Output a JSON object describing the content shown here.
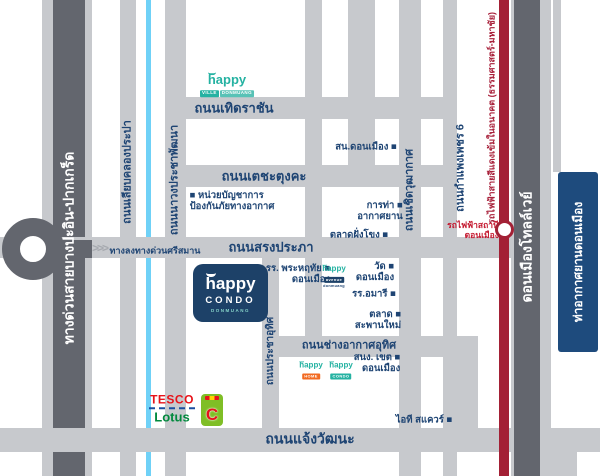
{
  "colors": {
    "road": "#c7c9cd",
    "road_dark": "#63666e",
    "canal": "#6fd1f7",
    "rail_red": "#a32035",
    "airport": "#1e4b7d",
    "navy": "#1e4473",
    "teal": "#25b2a2"
  },
  "map": {
    "ramp": {
      "chevrons": ">>>"
    },
    "roads": [
      {
        "name": "expressway-outer",
        "x": 42,
        "y": 0,
        "w": 50,
        "h": 476,
        "fill": "road"
      },
      {
        "name": "expressway-core",
        "x": 53,
        "y": 0,
        "w": 32,
        "h": 476,
        "fill": "road_dark"
      },
      {
        "name": "road-liap-khlong-prapa",
        "x": 120,
        "y": 0,
        "w": 16,
        "h": 476,
        "fill": "road"
      },
      {
        "name": "khlong-prapa-canal",
        "x": 146,
        "y": 0,
        "w": 5,
        "h": 476,
        "fill": "canal"
      },
      {
        "name": "road-nawong-pracha-phatthana",
        "x": 165,
        "y": 0,
        "w": 21,
        "h": 476,
        "fill": "road"
      },
      {
        "name": "road-thoet-rachan",
        "x": 165,
        "y": 97,
        "w": 281,
        "h": 22,
        "fill": "road"
      },
      {
        "name": "road-techa-tungkha",
        "x": 165,
        "y": 165,
        "w": 292,
        "h": 22,
        "fill": "road"
      },
      {
        "name": "road-song-prapha",
        "x": 0,
        "y": 237,
        "w": 515,
        "h": 21,
        "fill": "road"
      },
      {
        "name": "road-pracha-uthit",
        "x": 262,
        "y": 247,
        "w": 17,
        "h": 205,
        "fill": "road"
      },
      {
        "name": "road-top-a",
        "x": 305,
        "y": 0,
        "w": 17,
        "h": 357,
        "fill": "road"
      },
      {
        "name": "road-top-b",
        "x": 348,
        "y": 0,
        "w": 27,
        "h": 187,
        "fill": "road"
      },
      {
        "name": "road-cherd-wutthakat",
        "x": 399,
        "y": 0,
        "w": 22,
        "h": 476,
        "fill": "road"
      },
      {
        "name": "road-kamphaeng-phet-6",
        "x": 443,
        "y": 0,
        "w": 14,
        "h": 476,
        "fill": "road"
      },
      {
        "name": "road-chang-akat-uthit",
        "x": 262,
        "y": 336,
        "w": 216,
        "h": 21,
        "fill": "road"
      },
      {
        "name": "road-chang-akat-curve",
        "x": 456,
        "y": 336,
        "w": 22,
        "h": 112,
        "fill": "road",
        "r": "0 14px 0 0"
      },
      {
        "name": "road-chaeng-watthana",
        "x": 0,
        "y": 428,
        "w": 600,
        "h": 24,
        "fill": "road"
      },
      {
        "name": "redline",
        "x": 499,
        "y": 0,
        "w": 10,
        "h": 476,
        "fill": "rail_red"
      },
      {
        "name": "tollway-outer",
        "x": 511,
        "y": 0,
        "w": 40,
        "h": 476,
        "fill": "road"
      },
      {
        "name": "tollway-core",
        "x": 514,
        "y": 0,
        "w": 26,
        "h": 476,
        "fill": "road_dark"
      },
      {
        "name": "road-right-top",
        "x": 553,
        "y": 0,
        "w": 8,
        "h": 172,
        "fill": "road"
      },
      {
        "name": "road-right-bottom",
        "x": 551,
        "y": 448,
        "w": 26,
        "h": 28,
        "fill": "road"
      },
      {
        "name": "ramp-arm",
        "x": 30,
        "y": 240,
        "w": 62,
        "h": 18,
        "fill": "road_dark"
      },
      {
        "name": "airport-box",
        "x": 558,
        "y": 172,
        "w": 40,
        "h": 180,
        "fill": "airport",
        "r": "3px"
      }
    ],
    "labels": [
      {
        "name": "label-expressway",
        "text": "ทางด่วนสายบางปะอิน-ปากเกร็ด",
        "x": 69,
        "y": 248,
        "orient": "v",
        "cls": "white",
        "size": 14
      },
      {
        "name": "label-tollway",
        "text": "ดอนเมืองโทลล์เวย์",
        "x": 527,
        "y": 247,
        "orient": "v",
        "cls": "white",
        "size": 14
      },
      {
        "name": "label-airport",
        "text": "ท่าอากาศยานดอนเมือง",
        "x": 578,
        "y": 262,
        "orient": "v",
        "cls": "white",
        "size": 12
      },
      {
        "name": "label-liap-khlong-prapa",
        "text": "ถนนเลียบคลองประปา",
        "x": 128,
        "y": 172,
        "orient": "v",
        "cls": "road",
        "size": 11
      },
      {
        "name": "label-nawong-pracha-phatthana",
        "text": "ถนนนาวงประชาพัฒนา",
        "x": 175,
        "y": 180,
        "orient": "v",
        "cls": "road",
        "size": 11
      },
      {
        "name": "label-cherd-wutthakat",
        "text": "ถนนเชิดวุฒากาศ",
        "x": 410,
        "y": 190,
        "orient": "v",
        "cls": "road",
        "size": 11
      },
      {
        "name": "label-kamphaeng-phet-6",
        "text": "ถนนกำแพงเพชร 6",
        "x": 461,
        "y": 168,
        "orient": "v",
        "cls": "road",
        "size": 11
      },
      {
        "name": "label-pracha-uthit",
        "text": "ถนนประชาอุทิศ",
        "x": 271,
        "y": 351,
        "orient": "v",
        "cls": "road",
        "size": 10
      },
      {
        "name": "label-redline",
        "text": "รถไฟฟ้าสายสีแดงเข้มในอนาคต (ธรรมศาสตร์-มหาชัย)",
        "x": 492,
        "y": 118,
        "orient": "v",
        "cls": "red",
        "size": 9
      },
      {
        "name": "label-thoet-rachan",
        "text": "ถนนเทิดราชัน",
        "x": 234,
        "y": 108,
        "orient": "h",
        "cls": "road",
        "size": 13
      },
      {
        "name": "label-techa-tungkha",
        "text": "ถนนเตชะตุงคะ",
        "x": 264,
        "y": 176,
        "orient": "h",
        "cls": "road",
        "size": 13
      },
      {
        "name": "label-song-prapha",
        "text": "ถนนสรงประภา",
        "x": 271,
        "y": 247,
        "orient": "h",
        "cls": "road",
        "size": 13
      },
      {
        "name": "label-chang-akat-uthit",
        "text": "ถนนช่างอากาศอุทิศ",
        "x": 349,
        "y": 346,
        "orient": "h",
        "cls": "road",
        "size": 11
      },
      {
        "name": "label-chaeng-watthana",
        "text": "ถนนแจ้งวัฒนะ",
        "x": 310,
        "y": 439,
        "orient": "h",
        "cls": "road",
        "size": 14
      },
      {
        "name": "label-ramp-exit",
        "text": "ทางลงทางด่วนศรีสมาน",
        "x": 155,
        "y": 251,
        "orient": "h",
        "cls": "ramp",
        "size": 9
      },
      {
        "name": "poi-air-defense-command",
        "text": "■ หน่วยบัญชาการ\nป้องกันภัยทางอากาศ",
        "x": 232,
        "y": 201,
        "orient": "h",
        "cls": "poi",
        "size": 9.5,
        "align": "left"
      },
      {
        "name": "poi-don-mueang-police",
        "text": "สน.ดอนเมือง ■",
        "x": 366,
        "y": 147,
        "orient": "h",
        "cls": "poi",
        "size": 9.5
      },
      {
        "name": "poi-airports-authority",
        "text": "การท่า ■\nอากาศยาน",
        "x": 380,
        "y": 211,
        "orient": "h",
        "cls": "poi",
        "size": 9.5,
        "align": "right"
      },
      {
        "name": "poi-fang-khong-market",
        "text": "ตลาดฝั่งโขง ■",
        "x": 359,
        "y": 235,
        "orient": "h",
        "cls": "poi",
        "size": 9.5
      },
      {
        "name": "poi-phra-haruethai-school",
        "text": "รร. พระหฤทัย ■\nดอนเมือง",
        "x": 298,
        "y": 274,
        "orient": "h",
        "cls": "poi",
        "size": 9.5,
        "align": "right"
      },
      {
        "name": "poi-wat-don-mueang",
        "text": "วัด ■\nดอนเมือง",
        "x": 375,
        "y": 272,
        "orient": "h",
        "cls": "poi",
        "size": 9.5,
        "align": "right"
      },
      {
        "name": "poi-amari-hotel",
        "text": "รร.อมารี ■",
        "x": 374,
        "y": 294,
        "orient": "h",
        "cls": "poi",
        "size": 9.5
      },
      {
        "name": "poi-saphan-mai-market",
        "text": "ตลาด ■\nสะพานใหม่",
        "x": 378,
        "y": 320,
        "orient": "h",
        "cls": "poi",
        "size": 9.5,
        "align": "right"
      },
      {
        "name": "poi-district-office",
        "text": "สนง. เขต ■\nดอนเมือง",
        "x": 377,
        "y": 363,
        "orient": "h",
        "cls": "poi",
        "size": 9.5,
        "align": "right"
      },
      {
        "name": "poi-it-square",
        "text": "ไอที สแควร์ ■",
        "x": 424,
        "y": 420,
        "orient": "h",
        "cls": "poi",
        "size": 9.5
      },
      {
        "name": "poi-redline-station",
        "text": "รถไฟฟ้าสถานี\nดอนเมือง",
        "x": 473,
        "y": 230,
        "orient": "h",
        "cls": "red-poi",
        "size": 8.5,
        "align": "right"
      }
    ]
  },
  "logos": {
    "ville": {
      "word": "happy",
      "tag1": "VILLE",
      "tag2": "DONMUANG"
    },
    "main": {
      "word": "happy",
      "line2": "CONDO",
      "line3": "DONMUANG"
    },
    "avenue": {
      "word": "happy",
      "tag": "avenue",
      "sub": "donmuang"
    },
    "home": {
      "word": "happy",
      "tag": "HOME"
    },
    "condo_small": {
      "word": "happy",
      "tag": "CONDO"
    },
    "tesco": {
      "line1": "TESCO",
      "line2": "Lotus"
    },
    "bigc": {
      "letter": "C"
    }
  }
}
